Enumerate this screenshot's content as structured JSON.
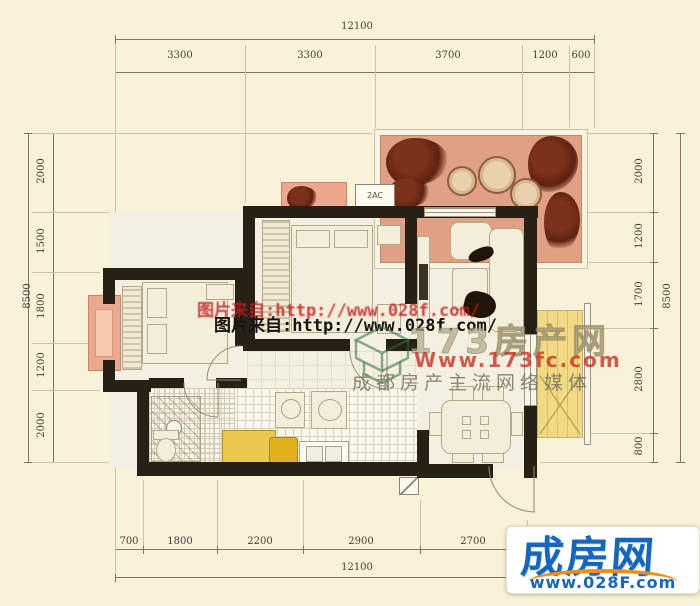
{
  "dimensions": {
    "top": {
      "total": "12100",
      "segments": [
        "3300",
        "3300",
        "3700",
        "1200",
        "600"
      ]
    },
    "bottom": {
      "total": "12100",
      "segments": [
        "700",
        "1800",
        "2200",
        "2900",
        "2700"
      ]
    },
    "left": {
      "total": "8500",
      "segments": [
        "2000",
        "1500",
        "1800",
        "1200",
        "2000"
      ]
    },
    "right": {
      "total": "8500",
      "segments": [
        "2000",
        "1200",
        "1700",
        "2800",
        "800"
      ]
    }
  },
  "plan": {
    "ac_label": "2AC"
  },
  "watermarks": {
    "line_red": "图片来自:http://www.028f.com/",
    "line_black": "图片来自:http://www.028f.com/",
    "brand_173": {
      "name": "173房产网",
      "url": "Www.173fc.com",
      "slogan": "成都房产主流网络媒体"
    }
  },
  "footer_logo": {
    "name": "成房网",
    "url": "www.028F.com"
  },
  "colors": {
    "terrace": "#dfa083",
    "balcony_pink": "#eda78c",
    "kitchen_yellow": "#eac84e",
    "balcony_yellow": "#f2d983",
    "logo_blue": "#1666bb",
    "logo_orange": "#ef8c1a",
    "watermark_red": "#c01c1c",
    "wall": "#262015",
    "background": "#f9f2d8"
  }
}
